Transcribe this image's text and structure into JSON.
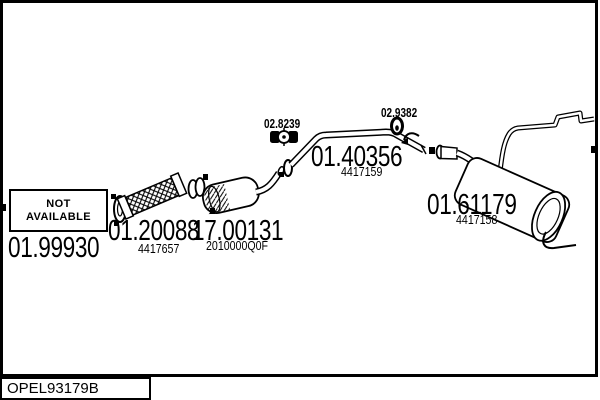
{
  "diagram": {
    "background": "#ffffff",
    "line_color": "#000000",
    "catalog_code": "OPEL93179B",
    "not_available": {
      "line1": "NOT",
      "line2": "AVAILABLE"
    },
    "parts": {
      "front_pipe": {
        "number": "01.99930"
      },
      "flex_pipe": {
        "number": "01.20088",
        "ref": "4417657"
      },
      "catalyst": {
        "number": "17.00131",
        "ref": "2010000Q0F"
      },
      "middle_pipe": {
        "number": "01.40356",
        "ref": "4417159"
      },
      "rear_muffler": {
        "number": "01.61179",
        "ref": "4417158"
      },
      "clamp": {
        "number": "02.8239"
      },
      "hanger": {
        "number": "02.9382"
      }
    }
  }
}
